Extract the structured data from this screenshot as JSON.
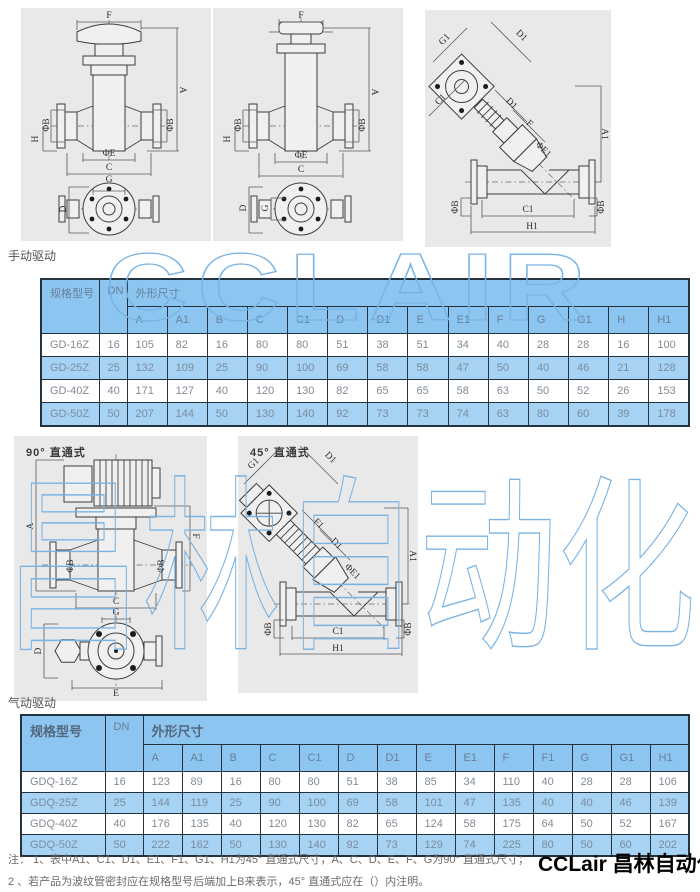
{
  "sections": {
    "manual_drive": "手动驱动",
    "pneumatic_drive": "气动驱动"
  },
  "watermarks": {
    "latin": "CCLAIR",
    "cjk": "昌林自动化",
    "color": "#79b3e3"
  },
  "panels": {
    "p1": {
      "labels": [
        {
          "t": "F",
          "x": 88,
          "y": 8,
          "r": 0
        },
        {
          "t": "A",
          "x": 161,
          "y": 82,
          "r": 90
        },
        {
          "t": "ΦB",
          "x": 26,
          "y": 117,
          "r": -90
        },
        {
          "t": "ΦB",
          "x": 150,
          "y": 117,
          "r": -90
        },
        {
          "t": "H",
          "x": 15,
          "y": 131,
          "r": -90
        },
        {
          "t": "ΦE",
          "x": 88,
          "y": 146,
          "r": 0
        },
        {
          "t": "C",
          "x": 88,
          "y": 160,
          "r": 0
        },
        {
          "t": "G",
          "x": 88,
          "y": 172,
          "r": 0
        },
        {
          "t": "D",
          "x": 43,
          "y": 201,
          "r": -90
        }
      ]
    },
    "p2": {
      "labels": [
        {
          "t": "F",
          "x": 88,
          "y": 8,
          "r": 0
        },
        {
          "t": "A",
          "x": 161,
          "y": 84,
          "r": 90
        },
        {
          "t": "ΦB",
          "x": 26,
          "y": 117,
          "r": -90
        },
        {
          "t": "ΦB",
          "x": 150,
          "y": 117,
          "r": -90
        },
        {
          "t": "H",
          "x": 15,
          "y": 131,
          "r": -90
        },
        {
          "t": "ΦE",
          "x": 88,
          "y": 148,
          "r": 0
        },
        {
          "t": "C",
          "x": 88,
          "y": 162,
          "r": 0
        },
        {
          "t": "D",
          "x": 31,
          "y": 200,
          "r": -90
        },
        {
          "t": "G",
          "x": 53,
          "y": 200,
          "r": -90
        }
      ]
    },
    "p3": {
      "labels": [
        {
          "t": "G1",
          "x": 20,
          "y": 30,
          "r": -45
        },
        {
          "t": "D1",
          "x": 96,
          "y": 26,
          "r": 45
        },
        {
          "t": "C1",
          "x": 16,
          "y": 90,
          "r": -45
        },
        {
          "t": "D1",
          "x": 86,
          "y": 94,
          "r": 45
        },
        {
          "t": "F",
          "x": 104,
          "y": 114,
          "r": 45
        },
        {
          "t": "ΦE1",
          "x": 118,
          "y": 140,
          "r": 45
        },
        {
          "t": "A1",
          "x": 179,
          "y": 124,
          "r": 90
        },
        {
          "t": "ΦB",
          "x": 31,
          "y": 197,
          "r": -90
        },
        {
          "t": "ΦB",
          "x": 177,
          "y": 197,
          "r": -90
        },
        {
          "t": "C1",
          "x": 103,
          "y": 200,
          "r": 0
        },
        {
          "t": "H1",
          "x": 107,
          "y": 217,
          "r": 0
        }
      ]
    },
    "p4": {
      "title": "90° 直通式",
      "labels": [
        {
          "t": "A",
          "x": 17,
          "y": 90,
          "r": -90
        },
        {
          "t": "F",
          "x": 181,
          "y": 100,
          "r": 90
        },
        {
          "t": "ΦB",
          "x": 57,
          "y": 130,
          "r": -90
        },
        {
          "t": "ΦB",
          "x": 148,
          "y": 130,
          "r": -90
        },
        {
          "t": "C",
          "x": 102,
          "y": 166,
          "r": 0
        },
        {
          "t": "G",
          "x": 102,
          "y": 177,
          "r": 0
        },
        {
          "t": "D",
          "x": 25,
          "y": 215,
          "r": -90
        },
        {
          "t": "E",
          "x": 102,
          "y": 258,
          "r": 0
        }
      ]
    },
    "p5": {
      "title": "45° 直通式",
      "labels": [
        {
          "t": "G1",
          "x": 16,
          "y": 28,
          "r": -45
        },
        {
          "t": "D1",
          "x": 92,
          "y": 22,
          "r": 45
        },
        {
          "t": "F1",
          "x": 80,
          "y": 88,
          "r": 45
        },
        {
          "t": "D1",
          "x": 98,
          "y": 108,
          "r": 45
        },
        {
          "t": "ΦE1",
          "x": 114,
          "y": 136,
          "r": 45
        },
        {
          "t": "A1",
          "x": 174,
          "y": 120,
          "r": 90
        },
        {
          "t": "ΦB",
          "x": 31,
          "y": 193,
          "r": -90
        },
        {
          "t": "ΦB",
          "x": 171,
          "y": 193,
          "r": -90
        },
        {
          "t": "C1",
          "x": 100,
          "y": 196,
          "r": 0
        },
        {
          "t": "H1",
          "x": 100,
          "y": 213,
          "r": 0
        }
      ]
    }
  },
  "table1": {
    "header": {
      "model": "规格型号",
      "dn": "DN",
      "dims": "外形尺寸"
    },
    "dim_cols": [
      "A",
      "A1",
      "B",
      "C",
      "C1",
      "D",
      "D1",
      "E",
      "E1",
      "F",
      "G",
      "G1",
      "H",
      "H1"
    ],
    "rows": [
      {
        "model": "GD-16Z",
        "dn": "16",
        "dims": [
          "105",
          "82",
          "16",
          "80",
          "80",
          "51",
          "38",
          "51",
          "34",
          "40",
          "28",
          "28",
          "16",
          "100"
        ]
      },
      {
        "model": "GD-25Z",
        "dn": "25",
        "dims": [
          "132",
          "109",
          "25",
          "90",
          "100",
          "69",
          "58",
          "58",
          "47",
          "50",
          "40",
          "46",
          "21",
          "128"
        ]
      },
      {
        "model": "GD-40Z",
        "dn": "40",
        "dims": [
          "171",
          "127",
          "40",
          "120",
          "130",
          "82",
          "65",
          "65",
          "58",
          "63",
          "50",
          "52",
          "26",
          "153"
        ]
      },
      {
        "model": "GD-50Z",
        "dn": "50",
        "dims": [
          "207",
          "144",
          "50",
          "130",
          "140",
          "92",
          "73",
          "73",
          "74",
          "63",
          "80",
          "60",
          "39",
          "178"
        ]
      }
    ]
  },
  "table2": {
    "header": {
      "model": "规格型号",
      "dn": "DN",
      "dims": "外形尺寸"
    },
    "dim_cols": [
      "A",
      "A1",
      "B",
      "C",
      "C1",
      "D",
      "D1",
      "E",
      "E1",
      "F",
      "F1",
      "G",
      "G1",
      "H1"
    ],
    "rows": [
      {
        "model": "GDQ-16Z",
        "dn": "16",
        "dims": [
          "123",
          "89",
          "16",
          "80",
          "80",
          "51",
          "38",
          "85",
          "34",
          "110",
          "40",
          "28",
          "28",
          "106"
        ]
      },
      {
        "model": "GDQ-25Z",
        "dn": "25",
        "dims": [
          "144",
          "119",
          "25",
          "90",
          "100",
          "69",
          "58",
          "101",
          "47",
          "135",
          "40",
          "40",
          "46",
          "139"
        ]
      },
      {
        "model": "GDQ-40Z",
        "dn": "40",
        "dims": [
          "176",
          "135",
          "40",
          "120",
          "130",
          "82",
          "65",
          "124",
          "58",
          "175",
          "64",
          "50",
          "52",
          "167"
        ]
      },
      {
        "model": "GDQ-50Z",
        "dn": "50",
        "dims": [
          "222",
          "162",
          "50",
          "130",
          "140",
          "92",
          "73",
          "129",
          "74",
          "225",
          "80",
          "50",
          "60",
          "202"
        ]
      }
    ]
  },
  "notes": {
    "line1": "注：  1、表中A1、C1、D1、E1、F1、G1、H1为45° 直通式尺寸，A、C、D、E、F、G为90° 直通式尺寸；",
    "line2": "2 、若产品为波纹管密封应在规格型号后端加上B来表示，45° 直通式应在（）内注明。"
  },
  "logo": "CCLair 昌林自动化",
  "colors": {
    "header_blue": "#8cc5f0",
    "row_blue": "#a6d2f4",
    "border": "#22323e",
    "panel_bg": "#e9e9e9"
  }
}
